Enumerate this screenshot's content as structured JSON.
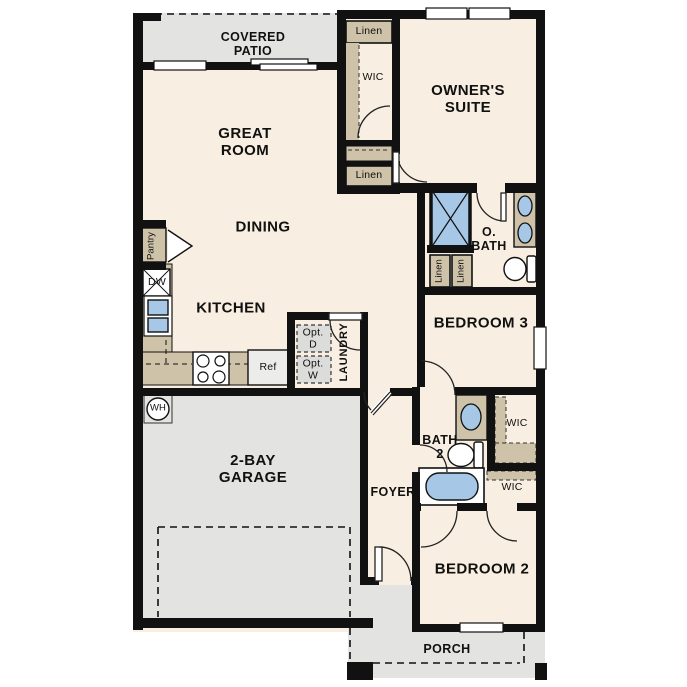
{
  "plan_title": "Single story floor plan",
  "colors": {
    "floor": "#f8eee1",
    "outdoor": "#e3e3e1",
    "wall": "#111111",
    "counter_tan": "#cec2a9",
    "fixture_blue": "#a7c7e7",
    "appliance_gray": "#ececea",
    "opt_box_gray": "#dcdcda"
  },
  "labels": {
    "covered_patio": "COVERED\nPATIO",
    "great_room": "GREAT\nROOM",
    "dining": "DINING",
    "kitchen": "KITCHEN",
    "owners_suite": "OWNER'S\nSUITE",
    "wic_top": "WIC",
    "linen_top": "Linen",
    "linen_mid": "Linen",
    "linen_obath_1": "Linen",
    "linen_obath_2": "Linen",
    "o_bath": "O.\nBATH",
    "bedroom3": "BEDROOM 3",
    "bath2": "BATH\n2",
    "wic_right_upper": "WIC",
    "wic_right_lower": "WIC",
    "foyer": "FOYER",
    "bedroom2": "BEDROOM 2",
    "garage": "2-BAY\nGARAGE",
    "porch": "PORCH",
    "laundry": "LAUNDRY",
    "opt_dryer": "Opt.\nD",
    "opt_washer": "Opt.\nW",
    "pantry": "Pantry",
    "dishwasher": "DW",
    "refrigerator": "Ref",
    "water_heater": "WH"
  }
}
